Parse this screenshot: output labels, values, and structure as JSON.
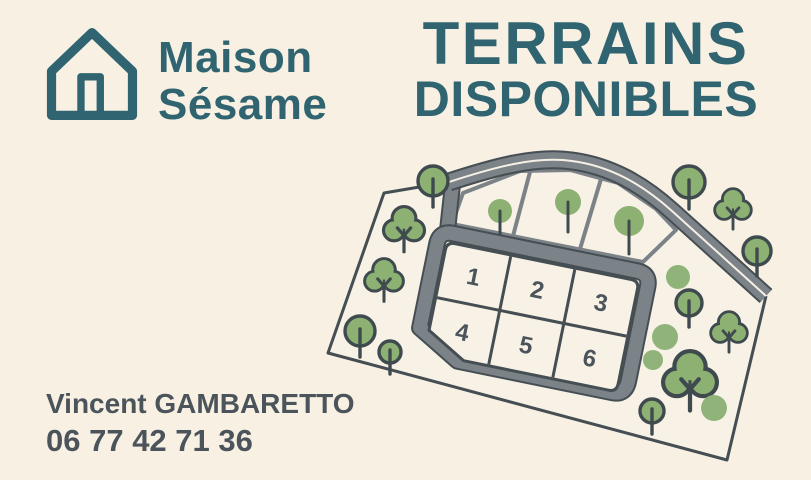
{
  "brand": {
    "name_line1": "Maison",
    "name_line2": "Sésame"
  },
  "headline": {
    "line1": "TERRAINS",
    "line2": "DISPONIBLES"
  },
  "contact": {
    "name": "Vincent GAMBARETTO",
    "phone": "06 77 42 71 36"
  },
  "site_plan": {
    "plot_numbers": [
      "1",
      "2",
      "3",
      "4",
      "5",
      "6"
    ],
    "unnumbered_top_plots": 3,
    "features": [
      "curved-access-road",
      "loop-road",
      "site-boundary",
      "trees"
    ]
  },
  "colors": {
    "background": "#f7f0e3",
    "brand_teal": "#2f6470",
    "text_dark": "#4b545b",
    "map_outline": "#454e53",
    "road_gray": "#7b8288",
    "tree_green": "#8cb173",
    "tree_dot_green": "#90b37a"
  }
}
